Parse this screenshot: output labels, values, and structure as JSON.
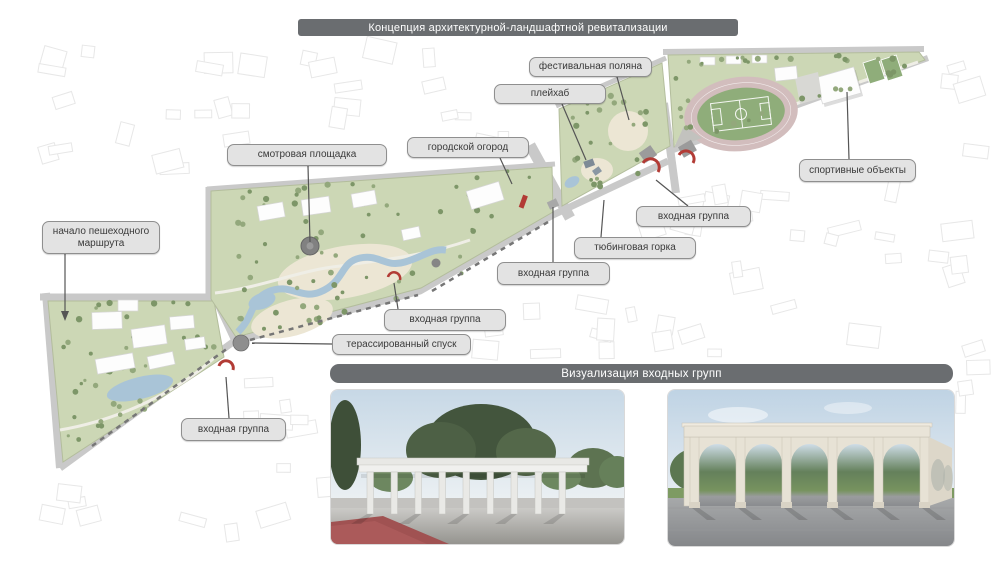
{
  "header": {
    "title": "Концепция архитектурной-ландшафтной ревитализации"
  },
  "visualization": {
    "title": "Визуализация входных групп"
  },
  "callouts": [
    {
      "id": "route-start",
      "label": "начало пешеходного маршрута"
    },
    {
      "id": "viewpoint",
      "label": "смотровая площадка"
    },
    {
      "id": "city-garden",
      "label": "городской огород"
    },
    {
      "id": "playhub",
      "label": "плейхаб"
    },
    {
      "id": "festival-glade",
      "label": "фестивальная поляна"
    },
    {
      "id": "sport-objects",
      "label": "спортивные объекты"
    },
    {
      "id": "entrance-top",
      "label": "входная группа"
    },
    {
      "id": "tubing-hill",
      "label": "тюбинговая горка"
    },
    {
      "id": "entrance-mid",
      "label": "входная группа"
    },
    {
      "id": "entrance-lower",
      "label": "входная группа"
    },
    {
      "id": "terraced-descent",
      "label": "терассированный спуск"
    },
    {
      "id": "entrance-bottom",
      "label": "входная группа"
    }
  ],
  "colors": {
    "banner_bg": "#6a6d70",
    "banner_text": "#ffffff",
    "label_bg": "#e3e3e3",
    "label_border": "#8f8f8f",
    "label_text": "#3a3a3a",
    "park_green": "#ccd7b5",
    "park_edge": "#b3bd9c",
    "tree_green": "#93a87c",
    "tree_dark": "#7d9668",
    "water_blue": "#a9c4d7",
    "sand": "#ece6d4",
    "road_gray": "#c9c9c9",
    "street_dash": "#767676",
    "accent_red": "#b23b35",
    "field_green": "#8fad7a",
    "track_pink": "#d2bdbd",
    "building_white": "#fdfdfd",
    "block_line": "#e7e7e7"
  }
}
